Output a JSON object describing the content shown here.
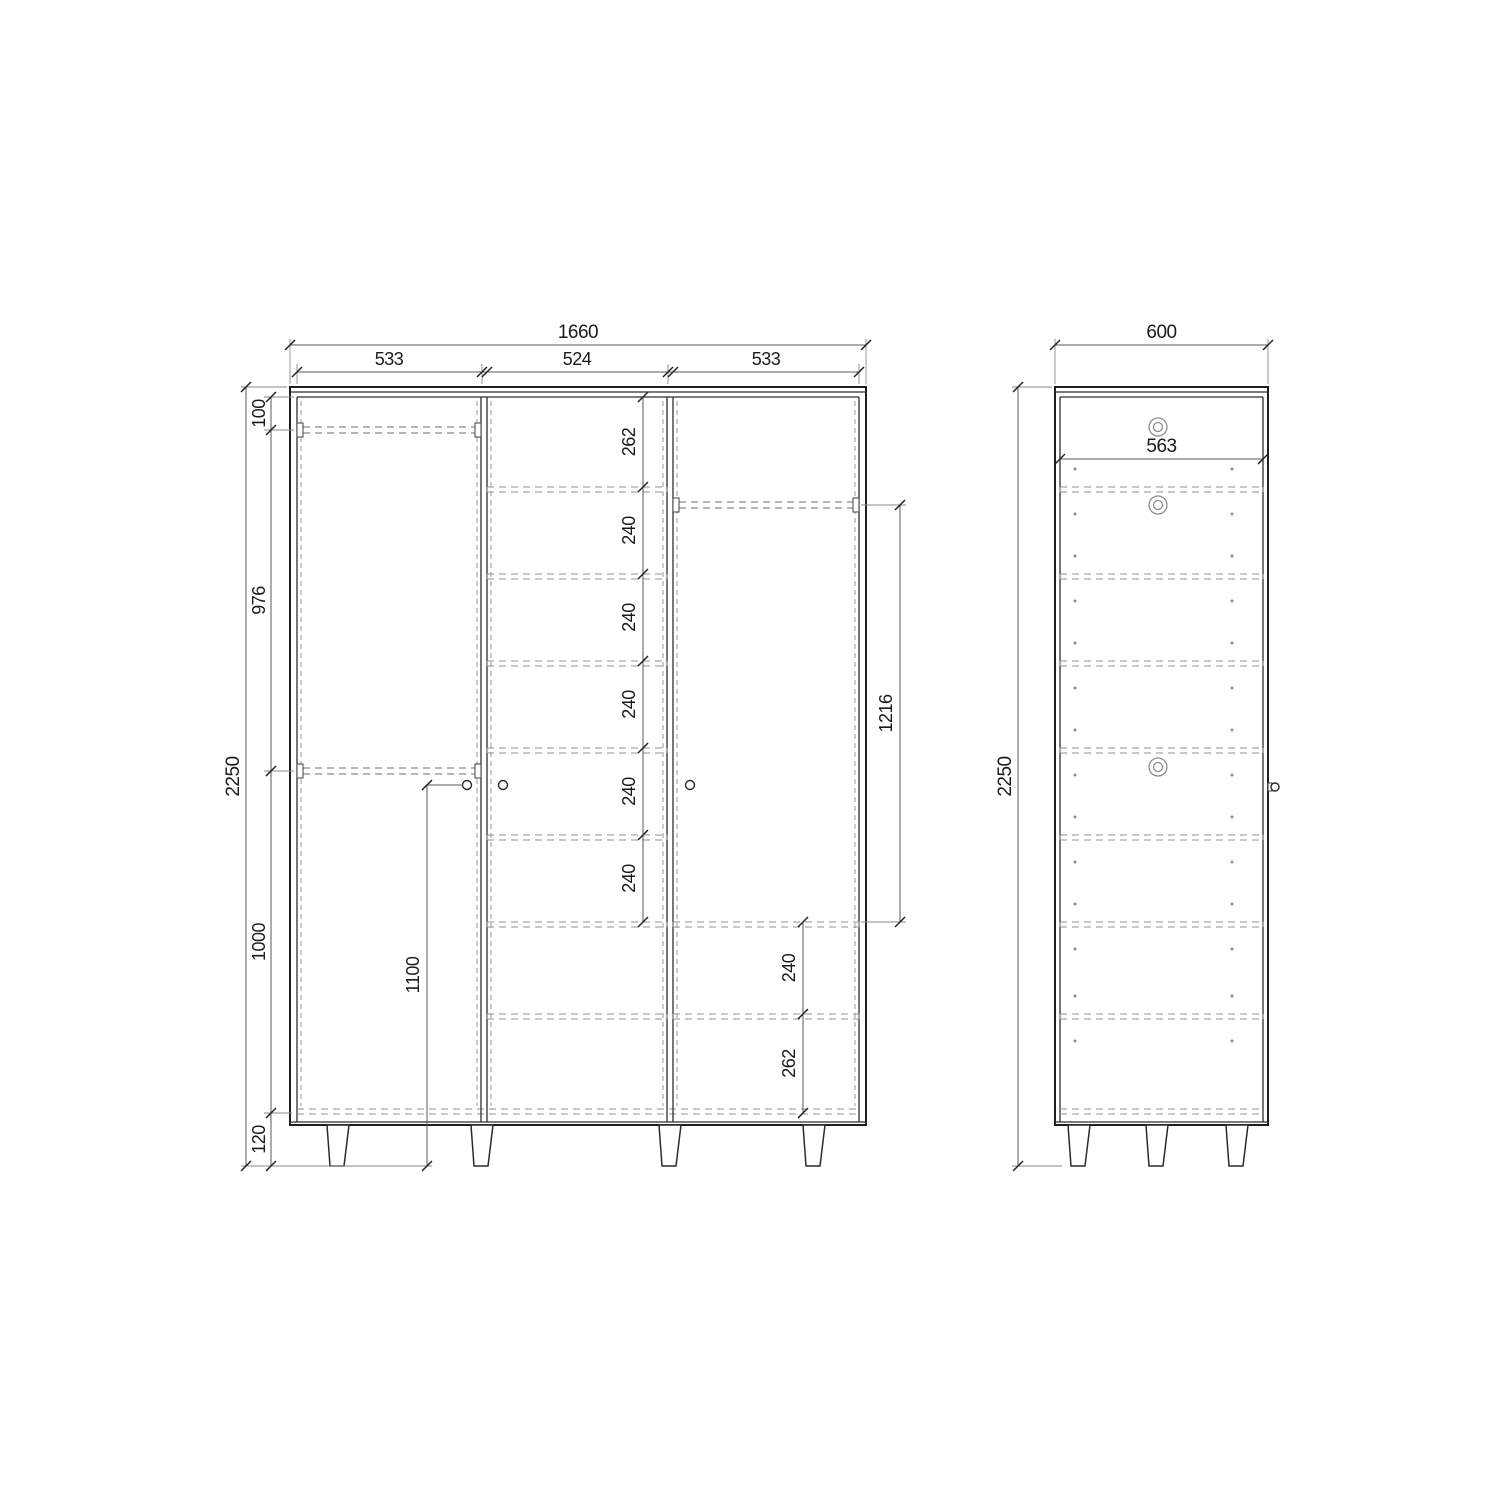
{
  "front_view": {
    "dims": {
      "overall_width": "1660",
      "left_door_width": "533",
      "middle_door_width": "524",
      "right_door_width": "533",
      "overall_height": "2250",
      "top_offset": "100",
      "rod_spacing": "976",
      "bottom_section_height": "1000",
      "leg_height": "120",
      "top_shelf_gap": "262",
      "shelf_gaps": [
        "240",
        "240",
        "240",
        "240",
        "240"
      ],
      "rod_to_shelf": "1216",
      "lower_shelf_gap": "240",
      "bottom_shelf_gap": "262",
      "handle_height": "1100"
    }
  },
  "side_view": {
    "dims": {
      "overall_depth": "600",
      "internal_depth": "563",
      "overall_height": "2250"
    }
  },
  "style": {
    "line_color": "#1e1e1e",
    "hidden_line_color": "#929292",
    "dimension_color": "#5a5a5a",
    "background": "#ffffff"
  }
}
